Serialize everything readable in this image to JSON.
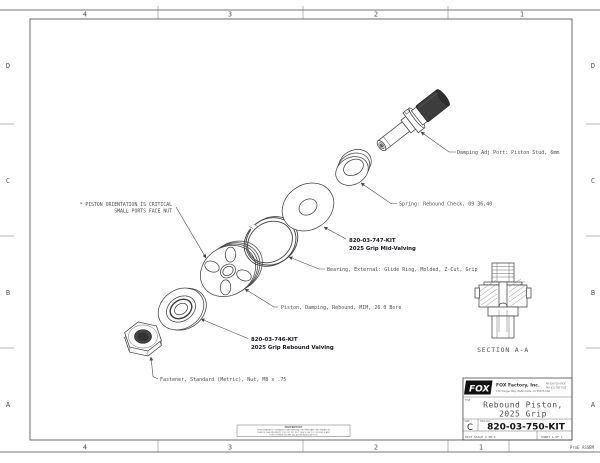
{
  "colors": {
    "line": "#424242",
    "dark_fill": "#3d3d3d",
    "callout_text": "#4f4f4f",
    "title_gray": "#808080"
  },
  "zones": {
    "top": [
      "4",
      "3",
      "2",
      "1"
    ],
    "bottom": [
      "4",
      "3",
      "2",
      "1"
    ],
    "left": [
      "D",
      "C",
      "B",
      "A"
    ],
    "right": [
      "D",
      "C",
      "B",
      "A"
    ]
  },
  "corner_note": "ProE ASSEM",
  "note": {
    "line1": "* PISTON ORIENTATION IS CRITICAL",
    "line2": "SMALL PORTS FACE NUT"
  },
  "callouts": {
    "stud": "Damping Adj Port: Piston Stud, 6mm",
    "spring": "Spring: Rebound Check, 09 36,40",
    "mid_kit": "820-03-747-KIT",
    "mid_kit2": "2025 Grip Mid-Valving",
    "bearing": "Bearing, External: Glide Ring, Molded, Z-Cut, Grip",
    "piston": "Piston, Damping, Rebound, MIM, 26.0 Bore",
    "reb_kit": "820-03-746-KIT",
    "reb_kit2": "2025 Grip Rebound Valving",
    "fastener": "Fastener, Standard (Metric), Nut, M8 x .75"
  },
  "section_label": "SECTION  A-A",
  "title_block": {
    "logo_text": "FOX",
    "company": "FOX Factory, Inc.",
    "address": "130 Hangar Way, Watsonville, CA 95076 USA",
    "phone": "PH 800-FOX-SHOX",
    "fax": "FAX 831-768-7026",
    "type_label": "TITLE",
    "title_line1": "Rebound Piston,",
    "title_line2": "2025 Grip",
    "size_label": "SIZE",
    "size": "C",
    "dwg_label": "DWG NO.",
    "dwg_no": "820-03-750-KIT",
    "plot_scale": "PLOT SCALE 2.08:1",
    "sheet": "SHEET 1 OF 1"
  },
  "proprietary": {
    "header": "PROPRIETARY",
    "line1": "THIS DRAWING CONTAINS CONFIDENTIAL PROPRIETARY INFORMATION",
    "line2": "THAT IS THE PROPERTY OF FOX. DO NOT DISCLOSE TO OR DUPLICATE",
    "line3": "FOR OTHERS EXCEPT AS AUTHORIZED BY FOX"
  }
}
